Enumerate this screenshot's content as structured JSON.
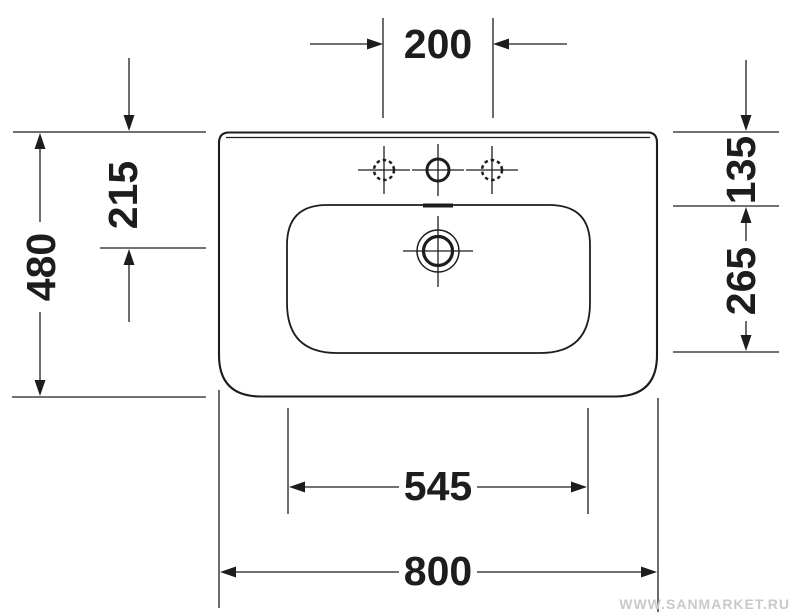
{
  "drawing": {
    "type": "washbasin-plan-view-technical-drawing",
    "watermark": "WWW.SANMARKET.RU",
    "colors": {
      "line": "#1d1d1b",
      "background": "#ffffff",
      "watermark": "#c9c9c9"
    },
    "dimensions": {
      "tap_hole_spacing": "200",
      "rear_to_drain": "215",
      "overall_depth": "480",
      "rear_to_bowl": "135",
      "bowl_depth": "265",
      "bowl_width": "545",
      "overall_width": "800"
    }
  }
}
